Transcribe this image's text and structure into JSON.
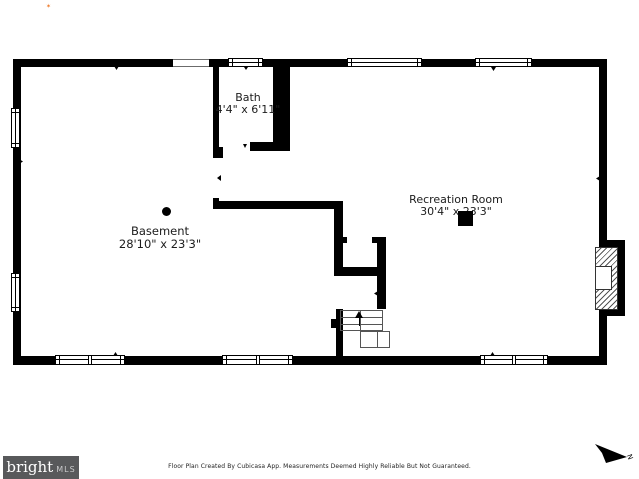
{
  "page": {
    "background": "#ffffff"
  },
  "floor_plan": {
    "wall_color": "#000000",
    "rooms": [
      {
        "name": "Bath",
        "dims": "4'4\" x 6'11\""
      },
      {
        "name": "Basement",
        "dims": "28'10\" x 23'3\""
      },
      {
        "name": "Recreation Room",
        "dims": "30'4\" x 23'3\""
      }
    ],
    "features": [
      "fireplace",
      "stairs-up",
      "support-column",
      "support-post"
    ],
    "compass": {
      "label": "N"
    }
  },
  "footer": {
    "disclaimer": "Floor Plan Created By Cubicasa App. Measurements Deemed Highly Reliable But Not Guaranteed.",
    "brand": {
      "wordmark": "bright",
      "suffix": "MLS",
      "box_color": "#58595b",
      "accent": "#ee7623"
    }
  }
}
